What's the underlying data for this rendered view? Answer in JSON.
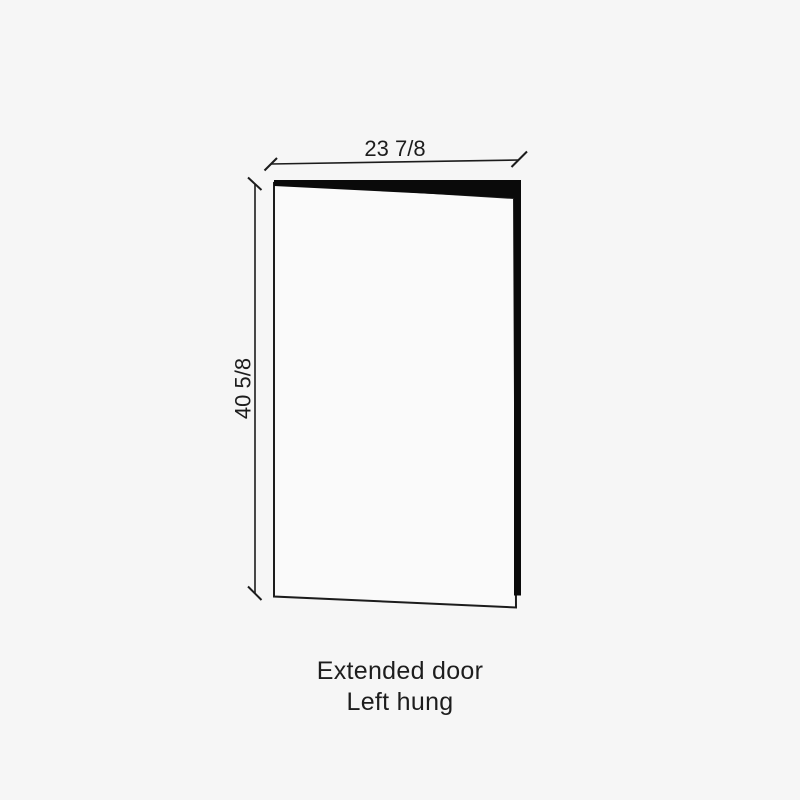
{
  "page": {
    "background": "#f6f6f6"
  },
  "door_diagram": {
    "type": "dimension-drawing",
    "width_dimension_label": "23 7/8",
    "height_dimension_label": "40 5/8",
    "caption": {
      "line1": "Extended door",
      "line2": "Left hung"
    },
    "colors": {
      "line": "#1c1c1c",
      "door_edge_fill": "#0a0a0a",
      "door_face_fill": "#fafafa",
      "text": "#1d1d1d"
    }
  }
}
